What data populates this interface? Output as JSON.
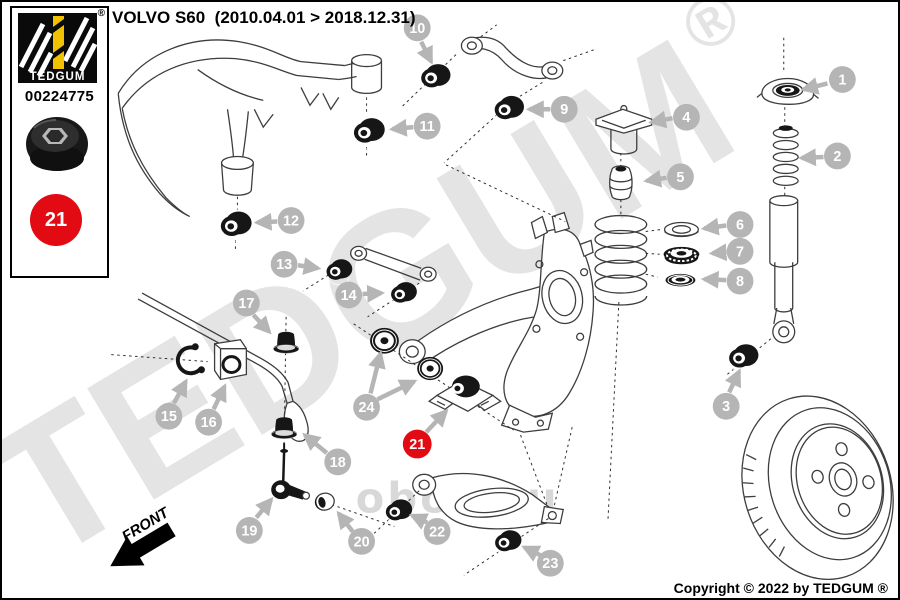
{
  "panel": {
    "brand": "TEDGUM",
    "registered_mark": "®",
    "part_number": "00224775",
    "badge_number": "21"
  },
  "header": {
    "title": "VOLVO S60  (2010.04.01 > 2018.12.31)"
  },
  "footer": {
    "copyright": "Copyright © 2022 by TEDGUM ®"
  },
  "diagram": {
    "front_label": "FRONT",
    "watermark_primary": "TEDGUM",
    "watermark_registered": "®",
    "watermark_secondary": "obop.ru",
    "highlight_color": "#e30b13",
    "callout_color": "#b5b5b5",
    "brand_yellow": "#f2c200",
    "callouts": [
      {
        "label": "1",
        "highlight": false
      },
      {
        "label": "2",
        "highlight": false
      },
      {
        "label": "3",
        "highlight": false
      },
      {
        "label": "4",
        "highlight": false
      },
      {
        "label": "5",
        "highlight": false
      },
      {
        "label": "6",
        "highlight": false
      },
      {
        "label": "7",
        "highlight": false
      },
      {
        "label": "8",
        "highlight": false
      },
      {
        "label": "9",
        "highlight": false
      },
      {
        "label": "10",
        "highlight": false
      },
      {
        "label": "11",
        "highlight": false
      },
      {
        "label": "12",
        "highlight": false
      },
      {
        "label": "13",
        "highlight": false
      },
      {
        "label": "14",
        "highlight": false
      },
      {
        "label": "15",
        "highlight": false
      },
      {
        "label": "16",
        "highlight": false
      },
      {
        "label": "17",
        "highlight": false
      },
      {
        "label": "18",
        "highlight": false
      },
      {
        "label": "19",
        "highlight": false
      },
      {
        "label": "20",
        "highlight": false
      },
      {
        "label": "21",
        "highlight": true
      },
      {
        "label": "22",
        "highlight": false
      },
      {
        "label": "23",
        "highlight": false
      },
      {
        "label": "24",
        "highlight": false
      }
    ]
  }
}
